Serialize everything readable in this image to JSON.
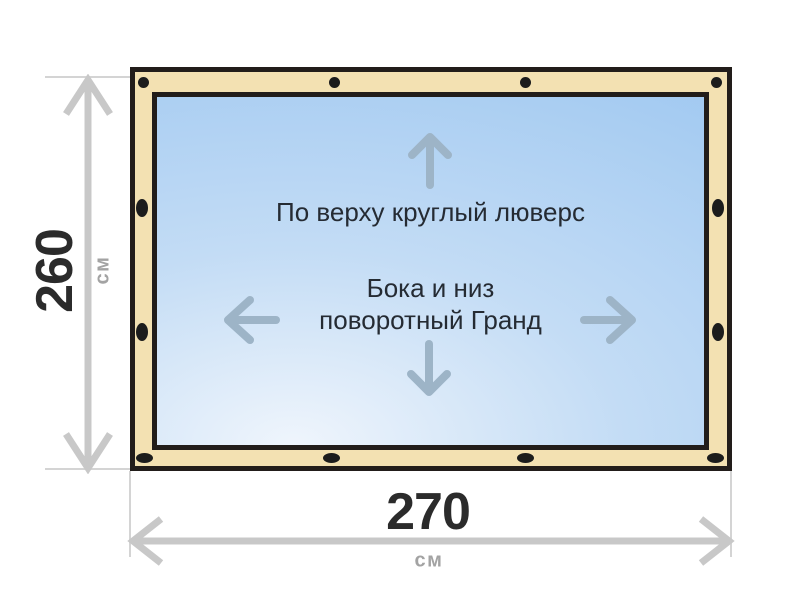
{
  "diagram": {
    "title": "tarp-grommet-layout-diagram",
    "panel": {
      "top_note": "По верху круглый люверс",
      "middle_note_line1": "Бока и низ",
      "middle_note_line2": "поворотный Гранд"
    },
    "dimensions": {
      "height": {
        "value": "260",
        "unit": "см"
      },
      "width": {
        "value": "270",
        "unit": "см"
      }
    },
    "fasteners": {
      "top_edge": {
        "type": "round-grommet",
        "count": 4
      },
      "bottom_edge": {
        "type": "turn-fastener-oval",
        "count": 4
      },
      "left_edge": {
        "type": "turn-fastener-oval",
        "count": 2
      },
      "right_edge": {
        "type": "turn-fastener-oval",
        "count": 2
      }
    },
    "icons": {
      "up_arrow": "up-arrow-icon",
      "down_arrow": "down-arrow-icon",
      "left_arrow": "left-arrow-icon",
      "right_arrow": "right-arrow-icon",
      "height_dimension": "vertical-double-arrow-icon",
      "width_dimension": "horizontal-double-arrow-icon"
    },
    "colors": {
      "background": "#ffffff",
      "frame_fill": "#f3e1b2",
      "frame_outline": "#221d1a",
      "grommet": "#1c1c1c",
      "panel_gradient_light": "#eff5fc",
      "panel_gradient_mid": "#c3dcf5",
      "panel_gradient_deep": "#a1c9f1",
      "direction_arrow": "#9db4c7",
      "dimension_arrow": "#c8c8c8",
      "extension_line": "#d4d4d4",
      "note_text": "#252b33",
      "dimension_value_text": "#2b2b2b",
      "unit_text": "#a3a3a3"
    }
  }
}
